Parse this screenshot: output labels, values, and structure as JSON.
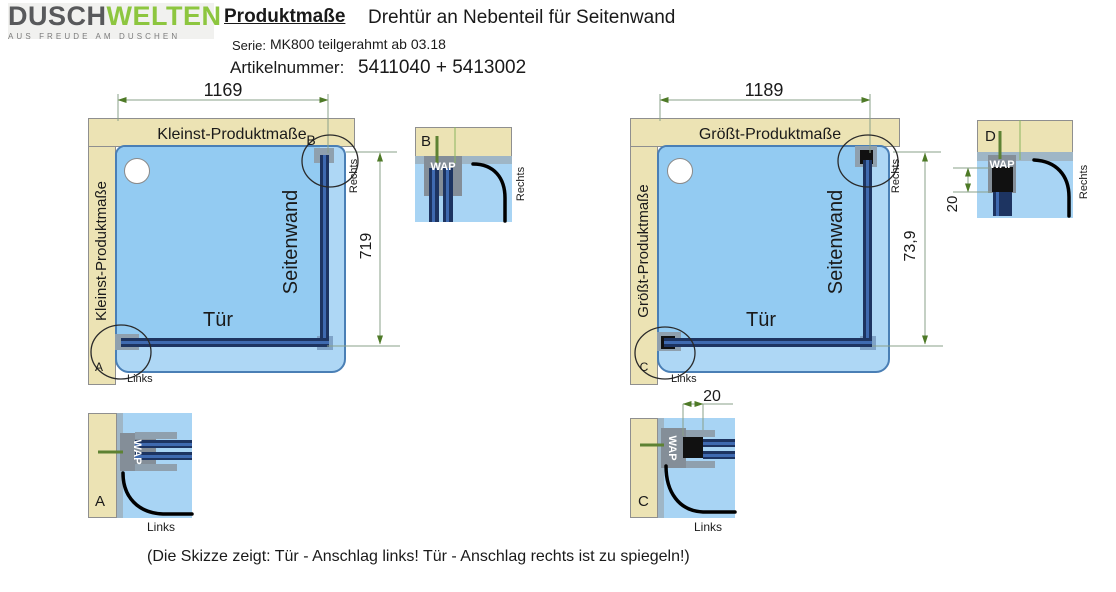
{
  "header": {
    "brand": {
      "name_black": "DUSCH",
      "name_green": "WELTEN",
      "tagline": "AUS FREUDE AM DUSCHEN"
    },
    "title": "Produktmaße",
    "subtitle": "Drehtür an Nebenteil für Seitenwand",
    "series": {
      "label": "Serie:",
      "value": "MK800 teilgerahmt ab 03.18"
    },
    "article": {
      "label": "Artikelnummer:",
      "value": "5411040 + 5413002"
    }
  },
  "left_diagram": {
    "title_top": "Kleinst-Produktmaße",
    "title_side": "Kleinst-Produktmaße",
    "width": "1169",
    "height": "719",
    "door": "Tür",
    "panel": "Seitenwand",
    "marker_top": "B",
    "marker_bottom": "A",
    "hinge_side": "Links",
    "wall_side": "Rechts"
  },
  "right_diagram": {
    "title_top": "Größt-Produktmaße",
    "title_side": "Größt-Produktmaße",
    "width": "1189",
    "height": "73,9",
    "door": "Tür",
    "panel": "Seitenwand",
    "marker_bottom": "C",
    "hinge_side": "Links",
    "wall_side": "Rechts",
    "adjust_top": "20",
    "adjust_bottom": "20"
  },
  "details": {
    "a": {
      "letter": "A",
      "profile": "WAP",
      "side": "Links"
    },
    "b": {
      "letter": "B",
      "profile": "WAP",
      "side": "Rechts"
    },
    "c": {
      "letter": "C",
      "profile": "WAP",
      "side": "Links"
    },
    "d": {
      "letter": "D",
      "profile": "WAP",
      "side": "Rechts"
    }
  },
  "footer": {
    "note": "(Die Skizze zeigt: Tür - Anschlag links! Tür - Anschlag rechts ist zu spiegeln!)"
  },
  "colors": {
    "brand_green": "#8dc63f",
    "brand_gray": "#58595b",
    "wall_beige": "#ece3b4",
    "tray_blue": "#aed7f5",
    "inner_blue": "#93cbf2",
    "glass_navy": "#1d3461",
    "wap_gray": "#848e98",
    "dimension_green": "#4e7a27"
  }
}
